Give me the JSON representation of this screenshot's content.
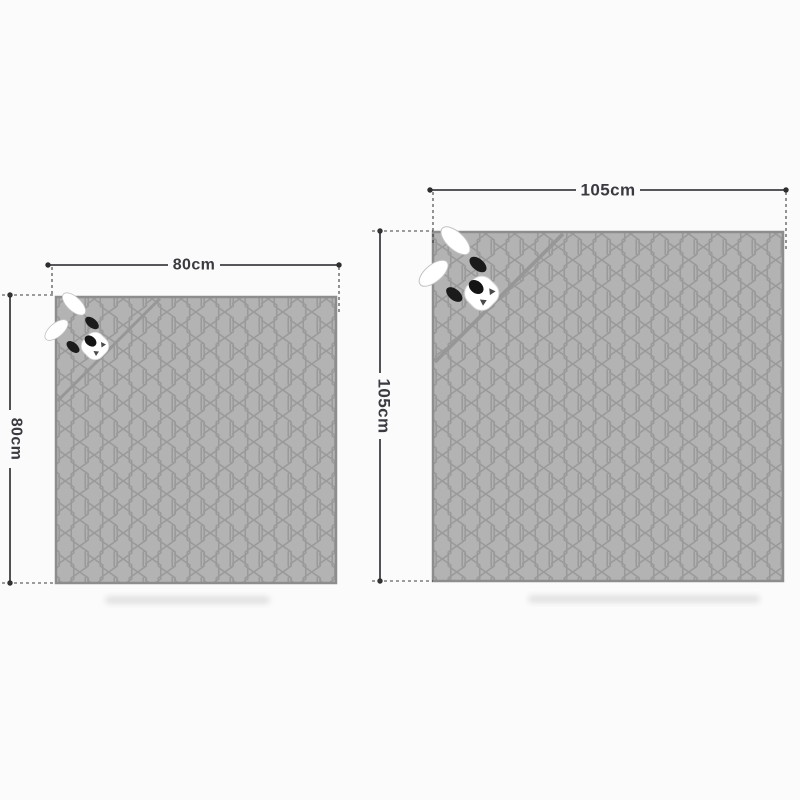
{
  "diagram": {
    "background_color": "#fbfbfb",
    "fabric": {
      "fill_color": "#b3b3b3",
      "stitch_color": "#9a9a9a",
      "edge_color": "#8d8d8d",
      "pattern": "hexagon-quilt"
    },
    "dimension_style": {
      "line_color": "#3f3f44",
      "label_color": "#3a3a40",
      "extension_line_style": "dashed",
      "endpoint_marker": "dot"
    },
    "icons": {
      "corner_applique": "animal-face-icon",
      "ears": "bunny-ears-icon",
      "fabric_texture": "hexagon-quilt-pattern"
    },
    "blankets": [
      {
        "id": "small-blanket",
        "width_label": "80cm",
        "height_label": "80cm",
        "width_cm": 80,
        "height_cm": 80,
        "corner_feature": "hood-fold-with-animal-face"
      },
      {
        "id": "large-blanket",
        "width_label": "105cm",
        "height_label": "105cm",
        "width_cm": 105,
        "height_cm": 105,
        "corner_feature": "hood-fold-with-animal-face"
      }
    ]
  }
}
